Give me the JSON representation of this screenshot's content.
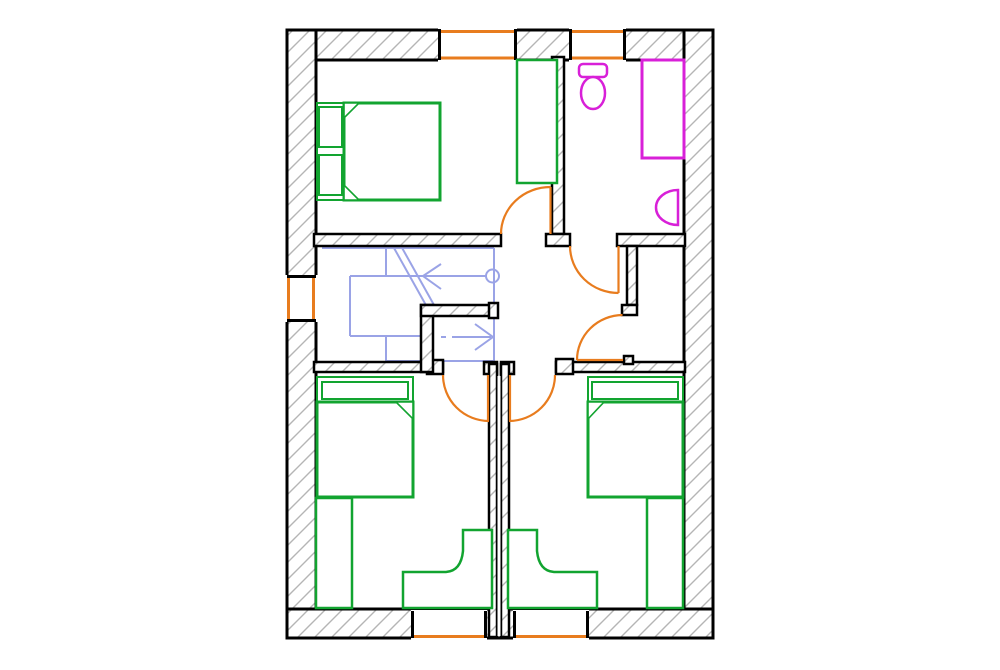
{
  "palette": {
    "wall": "#000000",
    "hatch_line": "#b5b5b5",
    "opening": "#e87c1e",
    "furniture": "#12a430",
    "sanitary": "#d820d8",
    "stairs": "#9aa3e6",
    "background": "#ffffff"
  },
  "drawing": {
    "canvas": {
      "width": 1000,
      "height": 670
    },
    "elements": [
      {
        "name": "wall-band-top",
        "kind": "rect",
        "x": 287,
        "y": 30,
        "w": 426,
        "h": 30,
        "fill": "hatch",
        "stroke": "wall",
        "sw": 3
      },
      {
        "name": "wall-band-left",
        "kind": "rect",
        "x": 287,
        "y": 30,
        "w": 29,
        "h": 608,
        "fill": "hatch",
        "stroke": "wall",
        "sw": 3
      },
      {
        "name": "wall-band-right",
        "kind": "rect",
        "x": 684,
        "y": 30,
        "w": 29,
        "h": 608,
        "fill": "hatch",
        "stroke": "wall",
        "sw": 3
      },
      {
        "name": "wall-band-bottom",
        "kind": "rect",
        "x": 287,
        "y": 609,
        "w": 426,
        "h": 29,
        "fill": "hatch",
        "stroke": "wall",
        "sw": 3
      },
      {
        "name": "window-top-1-opening",
        "kind": "rect",
        "x": 438,
        "y": 28,
        "w": 79,
        "h": 34,
        "fill": "white",
        "stroke": "none"
      },
      {
        "name": "window-top-1-outer",
        "kind": "line",
        "x1": 439,
        "y1": 31.5,
        "x2": 516,
        "y2": 31.5,
        "stroke": "opening",
        "sw": 3
      },
      {
        "name": "window-top-1-inner",
        "kind": "line",
        "x1": 439,
        "y1": 58,
        "x2": 516,
        "y2": 58,
        "stroke": "opening",
        "sw": 3
      },
      {
        "name": "window-top-1-jamb-left",
        "kind": "line",
        "x1": 439.5,
        "y1": 29,
        "x2": 439.5,
        "y2": 60,
        "stroke": "wall",
        "sw": 3
      },
      {
        "name": "window-top-1-jamb-right",
        "kind": "line",
        "x1": 515.5,
        "y1": 29,
        "x2": 515.5,
        "y2": 60,
        "stroke": "wall",
        "sw": 3
      },
      {
        "name": "window-top-2-opening",
        "kind": "rect",
        "x": 569,
        "y": 28,
        "w": 57,
        "h": 34,
        "fill": "white",
        "stroke": "none"
      },
      {
        "name": "window-top-2-outer",
        "kind": "line",
        "x1": 570,
        "y1": 31.5,
        "x2": 625,
        "y2": 31.5,
        "stroke": "opening",
        "sw": 3
      },
      {
        "name": "window-top-2-inner",
        "kind": "line",
        "x1": 570,
        "y1": 58,
        "x2": 625,
        "y2": 58,
        "stroke": "opening",
        "sw": 3
      },
      {
        "name": "window-top-2-jamb-left",
        "kind": "line",
        "x1": 570.5,
        "y1": 29,
        "x2": 570.5,
        "y2": 60,
        "stroke": "wall",
        "sw": 3
      },
      {
        "name": "window-top-2-jamb-right",
        "kind": "line",
        "x1": 624.5,
        "y1": 29,
        "x2": 624.5,
        "y2": 60,
        "stroke": "wall",
        "sw": 3
      },
      {
        "name": "window-left-opening",
        "kind": "rect",
        "x": 285,
        "y": 275,
        "w": 33,
        "h": 47,
        "fill": "white",
        "stroke": "none"
      },
      {
        "name": "window-left-outer",
        "kind": "line",
        "x1": 288.5,
        "y1": 276,
        "x2": 288.5,
        "y2": 321,
        "stroke": "opening",
        "sw": 3
      },
      {
        "name": "window-left-inner",
        "kind": "line",
        "x1": 313.5,
        "y1": 276,
        "x2": 313.5,
        "y2": 321,
        "stroke": "opening",
        "sw": 3
      },
      {
        "name": "window-left-jamb-top",
        "kind": "line",
        "x1": 287,
        "y1": 276.5,
        "x2": 316,
        "y2": 276.5,
        "stroke": "wall",
        "sw": 3
      },
      {
        "name": "window-left-jamb-bottom",
        "kind": "line",
        "x1": 287,
        "y1": 320.5,
        "x2": 316,
        "y2": 320.5,
        "stroke": "wall",
        "sw": 3
      },
      {
        "name": "window-bottom-1-opening",
        "kind": "rect",
        "x": 411,
        "y": 610,
        "w": 76,
        "h": 30,
        "fill": "white",
        "stroke": "none"
      },
      {
        "name": "window-bottom-1-outer",
        "kind": "line",
        "x1": 412,
        "y1": 636.5,
        "x2": 486,
        "y2": 636.5,
        "stroke": "opening",
        "sw": 3
      },
      {
        "name": "window-bottom-1-jamb-left",
        "kind": "line",
        "x1": 412.5,
        "y1": 611,
        "x2": 412.5,
        "y2": 638,
        "stroke": "wall",
        "sw": 3
      },
      {
        "name": "window-bottom-1-jamb-right",
        "kind": "line",
        "x1": 485.5,
        "y1": 611,
        "x2": 485.5,
        "y2": 638,
        "stroke": "wall",
        "sw": 3
      },
      {
        "name": "window-bottom-2-opening",
        "kind": "rect",
        "x": 513,
        "y": 610,
        "w": 76,
        "h": 30,
        "fill": "white",
        "stroke": "none"
      },
      {
        "name": "window-bottom-2-outer",
        "kind": "line",
        "x1": 514,
        "y1": 636.5,
        "x2": 588,
        "y2": 636.5,
        "stroke": "opening",
        "sw": 3
      },
      {
        "name": "window-bottom-2-jamb-left",
        "kind": "line",
        "x1": 514.5,
        "y1": 611,
        "x2": 514.5,
        "y2": 638,
        "stroke": "wall",
        "sw": 3
      },
      {
        "name": "window-bottom-2-jamb-right",
        "kind": "line",
        "x1": 587.5,
        "y1": 611,
        "x2": 587.5,
        "y2": 638,
        "stroke": "wall",
        "sw": 3
      },
      {
        "name": "stair-rail-top",
        "kind": "line",
        "x1": 322,
        "y1": 248,
        "x2": 494,
        "y2": 248,
        "stroke": "stairs",
        "sw": 2
      },
      {
        "name": "stair-rail-right",
        "kind": "line",
        "x1": 494,
        "y1": 248,
        "x2": 494,
        "y2": 361,
        "stroke": "stairs",
        "sw": 2
      },
      {
        "name": "stair-run-line-up",
        "kind": "line",
        "x1": 350,
        "y1": 276,
        "x2": 486,
        "y2": 276,
        "stroke": "stairs",
        "sw": 2
      },
      {
        "name": "stair-start-circle",
        "kind": "circle",
        "cx": 492.5,
        "cy": 276,
        "r": 6.5,
        "fill": "none",
        "stroke": "stairs",
        "sw": 2
      },
      {
        "name": "stair-arrow-up",
        "kind": "polyline",
        "points": "441,264 423,276 441,289",
        "fill": "none",
        "stroke": "stairs",
        "sw": 2
      },
      {
        "name": "stair-tread-1",
        "kind": "line",
        "x1": 386,
        "y1": 248,
        "x2": 386,
        "y2": 276,
        "stroke": "stairs",
        "sw": 2
      },
      {
        "name": "stair-tread-2",
        "kind": "line",
        "x1": 350,
        "y1": 276,
        "x2": 350,
        "y2": 336,
        "stroke": "stairs",
        "sw": 2
      },
      {
        "name": "stair-tread-3",
        "kind": "line",
        "x1": 350,
        "y1": 336,
        "x2": 421,
        "y2": 336,
        "stroke": "stairs",
        "sw": 2
      },
      {
        "name": "stair-tread-4",
        "kind": "line",
        "x1": 386,
        "y1": 336,
        "x2": 386,
        "y2": 361,
        "stroke": "stairs",
        "sw": 2
      },
      {
        "name": "stair-rail-bottom",
        "kind": "line",
        "x1": 386,
        "y1": 361,
        "x2": 494,
        "y2": 361,
        "stroke": "stairs",
        "sw": 2
      },
      {
        "name": "stair-break-line-1",
        "kind": "line",
        "x1": 394,
        "y1": 248,
        "x2": 427,
        "y2": 307,
        "stroke": "stairs",
        "sw": 2
      },
      {
        "name": "stair-break-line-2",
        "kind": "line",
        "x1": 401,
        "y1": 246,
        "x2": 434,
        "y2": 305,
        "stroke": "stairs",
        "sw": 2
      },
      {
        "name": "stair-run-dash",
        "kind": "line",
        "x1": 441,
        "y1": 337,
        "x2": 446,
        "y2": 337,
        "stroke": "stairs",
        "sw": 2
      },
      {
        "name": "stair-run-line-down",
        "kind": "line",
        "x1": 452,
        "y1": 337,
        "x2": 491,
        "y2": 337,
        "stroke": "stairs",
        "sw": 2
      },
      {
        "name": "stair-arrow-down",
        "kind": "polyline",
        "points": "475,324 493,337 475,350",
        "fill": "none",
        "stroke": "stairs",
        "sw": 2
      },
      {
        "name": "wall-bedroom1-south",
        "kind": "rect",
        "x": 314,
        "y": 234,
        "w": 187,
        "h": 12,
        "fill": "hatch",
        "stroke": "wall",
        "sw": 2.5
      },
      {
        "name": "wall-bedroom1-bath-divider",
        "kind": "rect",
        "x": 552,
        "y": 57,
        "w": 12,
        "h": 177,
        "fill": "hatch",
        "stroke": "wall",
        "sw": 2.5
      },
      {
        "name": "wall-divider-foot",
        "kind": "rect",
        "x": 546,
        "y": 234,
        "w": 24,
        "h": 12,
        "fill": "hatch",
        "stroke": "wall",
        "sw": 2.5
      },
      {
        "name": "wall-bathroom-south",
        "kind": "rect",
        "x": 617,
        "y": 234,
        "w": 68,
        "h": 12,
        "fill": "hatch",
        "stroke": "wall",
        "sw": 2.5
      },
      {
        "name": "wall-closet-west",
        "kind": "rect",
        "x": 627,
        "y": 246,
        "w": 10,
        "h": 59,
        "fill": "hatch",
        "stroke": "wall",
        "sw": 2.5
      },
      {
        "name": "wall-closet-west-foot",
        "kind": "rect",
        "x": 622,
        "y": 305,
        "w": 15,
        "h": 10,
        "fill": "hatch",
        "stroke": "wall",
        "sw": 2.5
      },
      {
        "name": "wall-hall-south-east",
        "kind": "rect",
        "x": 556,
        "y": 362,
        "w": 129,
        "h": 10,
        "fill": "hatch",
        "stroke": "wall",
        "sw": 2.5
      },
      {
        "name": "wall-hall-south-east-jamb",
        "kind": "rect",
        "x": 556,
        "y": 359,
        "w": 17,
        "h": 15,
        "fill": "hatch",
        "stroke": "wall",
        "sw": 2.5
      },
      {
        "name": "wall-closet-door-jamb",
        "kind": "rect",
        "x": 624,
        "y": 356,
        "w": 9,
        "h": 8,
        "fill": "hatch",
        "stroke": "wall",
        "sw": 2.5
      },
      {
        "name": "wall-stair-south",
        "kind": "rect",
        "x": 314,
        "y": 362,
        "w": 129,
        "h": 10,
        "fill": "hatch",
        "stroke": "wall",
        "sw": 2.5
      },
      {
        "name": "wall-stair-south-jamb",
        "kind": "rect",
        "x": 427,
        "y": 360,
        "w": 16,
        "h": 14,
        "fill": "hatch",
        "stroke": "wall",
        "sw": 2.5
      },
      {
        "name": "wall-stair-corner-vertical",
        "kind": "rect",
        "x": 421,
        "y": 305,
        "w": 12,
        "h": 67,
        "fill": "hatch",
        "stroke": "wall",
        "sw": 2.5
      },
      {
        "name": "wall-stair-corner-horizontal",
        "kind": "rect",
        "x": 421,
        "y": 305,
        "w": 71,
        "h": 11,
        "fill": "hatch",
        "stroke": "wall",
        "sw": 2.5
      },
      {
        "name": "wall-stair-corner-jamb",
        "kind": "rect",
        "x": 489,
        "y": 303,
        "w": 9,
        "h": 15,
        "fill": "hatch",
        "stroke": "wall",
        "sw": 2.5
      },
      {
        "name": "wall-party-head-left",
        "kind": "rect",
        "x": 484,
        "y": 362,
        "w": 13,
        "h": 12,
        "fill": "hatch",
        "stroke": "wall",
        "sw": 2.5
      },
      {
        "name": "wall-party-head-right",
        "kind": "rect",
        "x": 501,
        "y": 362,
        "w": 13,
        "h": 12,
        "fill": "hatch",
        "stroke": "wall",
        "sw": 2.5
      },
      {
        "name": "wall-party-left",
        "kind": "rect",
        "x": 489,
        "y": 364,
        "w": 8,
        "h": 273,
        "fill": "hatch",
        "stroke": "wall",
        "sw": 2.5
      },
      {
        "name": "wall-party-right",
        "kind": "rect",
        "x": 501,
        "y": 364,
        "w": 8,
        "h": 273,
        "fill": "hatch",
        "stroke": "wall",
        "sw": 2.5
      },
      {
        "name": "wall-party-gap",
        "kind": "rect",
        "x": 497.5,
        "y": 376,
        "w": 3,
        "h": 260,
        "fill": "white",
        "stroke": "none"
      },
      {
        "name": "door-bedroom1-panel",
        "kind": "line",
        "x1": 550.5,
        "y1": 187,
        "x2": 550.5,
        "y2": 234,
        "stroke": "opening",
        "sw": 2.2
      },
      {
        "name": "door-bedroom1-arc",
        "kind": "path",
        "d": "M501,234 A49.5,47 0 0 1 550.5,187",
        "fill": "none",
        "stroke": "opening",
        "sw": 2.2
      },
      {
        "name": "door-bathroom-panel",
        "kind": "line",
        "x1": 618.5,
        "y1": 246,
        "x2": 618.5,
        "y2": 293,
        "stroke": "opening",
        "sw": 2.2
      },
      {
        "name": "door-bathroom-arc",
        "kind": "path",
        "d": "M570,246 A48.5,47 0 0 0 618.5,293",
        "fill": "none",
        "stroke": "opening",
        "sw": 2.2
      },
      {
        "name": "door-closet-panel",
        "kind": "line",
        "x1": 577,
        "y1": 360,
        "x2": 623,
        "y2": 360,
        "stroke": "opening",
        "sw": 2.2
      },
      {
        "name": "door-closet-arc",
        "kind": "path",
        "d": "M622.5,315 A46,45 0 0 0 577,360",
        "fill": "none",
        "stroke": "opening",
        "sw": 2.2
      },
      {
        "name": "door-bedroom2-panel",
        "kind": "line",
        "x1": 488,
        "y1": 375,
        "x2": 488,
        "y2": 421,
        "stroke": "opening",
        "sw": 2.2
      },
      {
        "name": "door-bedroom2-arc",
        "kind": "path",
        "d": "M443,375 A46,46 0 0 0 489,421",
        "fill": "none",
        "stroke": "opening",
        "sw": 2.2
      },
      {
        "name": "door-bedroom3-panel",
        "kind": "line",
        "x1": 510,
        "y1": 375,
        "x2": 510,
        "y2": 421,
        "stroke": "opening",
        "sw": 2.2
      },
      {
        "name": "door-bedroom3-arc",
        "kind": "path",
        "d": "M555,375 A46,46 0 0 1 509,421",
        "fill": "none",
        "stroke": "opening",
        "sw": 2.2
      },
      {
        "name": "bed-master-frame",
        "kind": "rect",
        "x": 317,
        "y": 103,
        "w": 123,
        "h": 97,
        "fill": "white",
        "stroke": "furniture",
        "sw": 2
      },
      {
        "name": "bed-master-pillow-1",
        "kind": "rect",
        "x": 319,
        "y": 107,
        "w": 23,
        "h": 40,
        "fill": "none",
        "stroke": "furniture",
        "sw": 2
      },
      {
        "name": "bed-master-pillow-2",
        "kind": "rect",
        "x": 319,
        "y": 155,
        "w": 23,
        "h": 40,
        "fill": "none",
        "stroke": "furniture",
        "sw": 2
      },
      {
        "name": "bed-master-mattress",
        "kind": "rect",
        "x": 344,
        "y": 103,
        "w": 96,
        "h": 97,
        "fill": "none",
        "stroke": "furniture",
        "sw": 3
      },
      {
        "name": "bed-master-fold-top",
        "kind": "path",
        "d": "M344,103 L359,103 L344,118 Z",
        "fill": "white",
        "stroke": "furniture",
        "sw": 1.6
      },
      {
        "name": "bed-master-fold-bottom",
        "kind": "path",
        "d": "M344,200 L359,200 L344,185 Z",
        "fill": "white",
        "stroke": "furniture",
        "sw": 1.6
      },
      {
        "name": "wardrobe-master",
        "kind": "rect",
        "x": 517,
        "y": 60,
        "w": 40,
        "h": 123,
        "fill": "white",
        "stroke": "furniture",
        "sw": 2.5
      },
      {
        "name": "bed-left-frame",
        "kind": "rect",
        "x": 317,
        "y": 377,
        "w": 96,
        "h": 120,
        "fill": "white",
        "stroke": "furniture",
        "sw": 2
      },
      {
        "name": "bed-left-headboard",
        "kind": "rect",
        "x": 322,
        "y": 382,
        "w": 86,
        "h": 17,
        "fill": "none",
        "stroke": "furniture",
        "sw": 2
      },
      {
        "name": "bed-left-mattress",
        "kind": "rect",
        "x": 317,
        "y": 402,
        "w": 96,
        "h": 95,
        "fill": "none",
        "stroke": "furniture",
        "sw": 3
      },
      {
        "name": "bed-left-fold",
        "kind": "path",
        "d": "M396,402 L413,402 L413,419 Z",
        "fill": "white",
        "stroke": "furniture",
        "sw": 1.6
      },
      {
        "name": "wardrobe-left",
        "kind": "rect",
        "x": 316,
        "y": 498,
        "w": 36,
        "h": 110,
        "fill": "white",
        "stroke": "furniture",
        "sw": 2.5
      },
      {
        "name": "desk-left",
        "kind": "path",
        "d": "M463,530 L492,530 L492,608 L403,608 L403,572 L446,572 Q461,571 463,551 Z",
        "fill": "white",
        "stroke": "furniture",
        "sw": 2.5
      },
      {
        "name": "bed-right-frame",
        "kind": "rect",
        "x": 588,
        "y": 377,
        "w": 95,
        "h": 120,
        "fill": "white",
        "stroke": "furniture",
        "sw": 2
      },
      {
        "name": "bed-right-headboard",
        "kind": "rect",
        "x": 592,
        "y": 382,
        "w": 86,
        "h": 17,
        "fill": "none",
        "stroke": "furniture",
        "sw": 2
      },
      {
        "name": "bed-right-mattress",
        "kind": "rect",
        "x": 588,
        "y": 402,
        "w": 95,
        "h": 95,
        "fill": "none",
        "stroke": "furniture",
        "sw": 3
      },
      {
        "name": "bed-right-fold",
        "kind": "path",
        "d": "M604,402 L588,402 L588,419 Z",
        "fill": "white",
        "stroke": "furniture",
        "sw": 1.6
      },
      {
        "name": "wardrobe-right",
        "kind": "rect",
        "x": 647,
        "y": 498,
        "w": 36,
        "h": 110,
        "fill": "white",
        "stroke": "furniture",
        "sw": 2.5
      },
      {
        "name": "desk-right",
        "kind": "path",
        "d": "M537,530 L508,530 L508,608 L597,608 L597,572 L554,572 Q539,571 537,551 Z",
        "fill": "white",
        "stroke": "furniture",
        "sw": 2.5
      },
      {
        "name": "toilet-tank",
        "kind": "rect",
        "x": 579,
        "y": 64,
        "w": 28,
        "h": 13,
        "rx": 4,
        "fill": "white",
        "stroke": "sanitary",
        "sw": 2.5
      },
      {
        "name": "toilet-bowl",
        "kind": "ellipse",
        "cx": 593,
        "cy": 93,
        "rx": 12,
        "ry": 16,
        "fill": "white",
        "stroke": "sanitary",
        "sw": 2.5
      },
      {
        "name": "bathtub",
        "kind": "rect",
        "x": 642,
        "y": 60,
        "w": 42,
        "h": 98,
        "fill": "white",
        "stroke": "sanitary",
        "sw": 3
      },
      {
        "name": "sink",
        "kind": "path",
        "d": "M678,190 A22,17.5 0 0 0 678,225 Z",
        "fill": "white",
        "stroke": "sanitary",
        "sw": 2.5
      }
    ]
  }
}
